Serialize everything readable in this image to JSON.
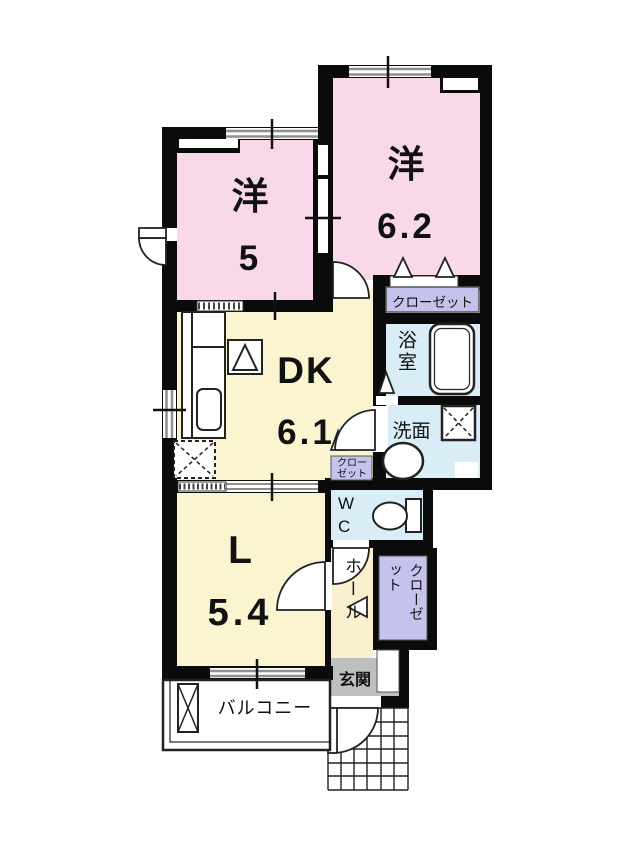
{
  "floorplan": {
    "rooms": {
      "western1": {
        "name": "洋",
        "size": "5"
      },
      "western2": {
        "name": "洋",
        "size": "6.2"
      },
      "dk": {
        "name": "DK",
        "size": "6.1"
      },
      "living": {
        "name": "L",
        "size": "5.4"
      },
      "bath": {
        "label": "浴室"
      },
      "washroom": {
        "label": "洗面"
      },
      "wc": {
        "label": "WC"
      },
      "hall": {
        "label": "ホール"
      },
      "entrance": {
        "label": "玄関"
      },
      "balcony": {
        "label": "バルコニー"
      },
      "closet_main": {
        "label": "クローゼット"
      },
      "closet_dk": {
        "label": "クローゼット"
      },
      "closet_hall": {
        "label": "クローゼット"
      }
    },
    "colors": {
      "wall": "#0b0b0b",
      "western_room": "#f9d9e9",
      "dk_living": "#faf5d0",
      "wet_area": "#d8edf6",
      "closet": "#c6c2ee",
      "entrance": "#bfbfbf",
      "window": "#8f8f8f"
    }
  }
}
